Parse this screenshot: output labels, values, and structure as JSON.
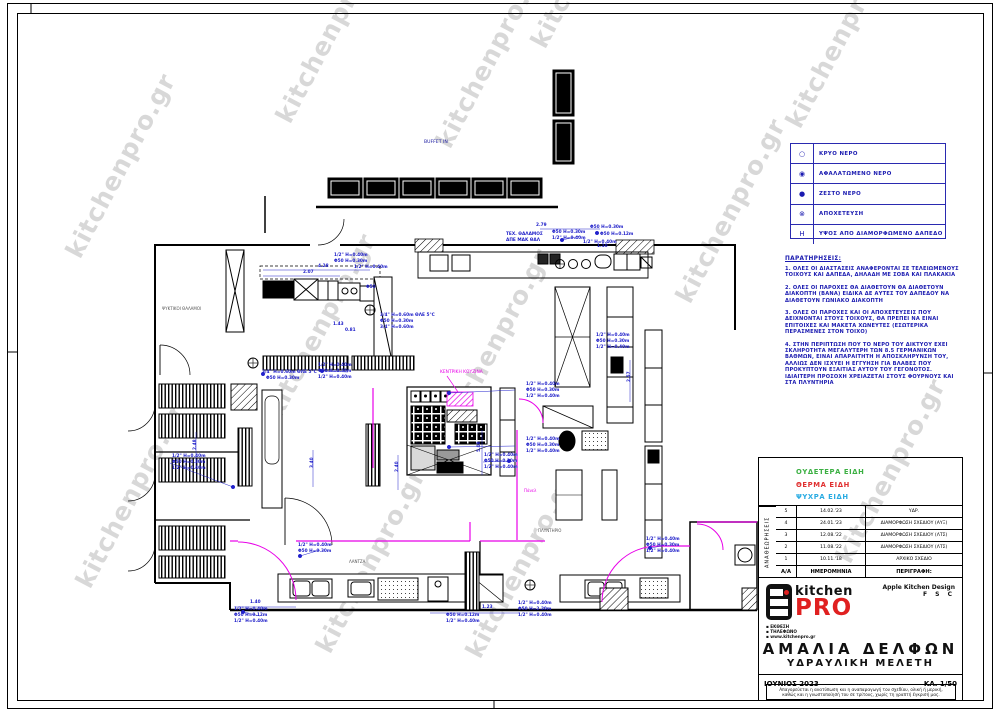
{
  "watermark": {
    "text": "kitchenpro.gr",
    "color": "#b9b9b9",
    "positions": [
      [
        90,
        590
      ],
      [
        80,
        260
      ],
      [
        290,
        125
      ],
      [
        280,
        420
      ],
      [
        330,
        655
      ],
      [
        450,
        150
      ],
      [
        455,
        435
      ],
      [
        480,
        660
      ],
      [
        545,
        50
      ],
      [
        690,
        305
      ],
      [
        800,
        130
      ],
      [
        850,
        565
      ]
    ]
  },
  "legend": {
    "rows": [
      {
        "symbol": "○",
        "label": "ΚΡΥΟ ΝΕΡΟ"
      },
      {
        "symbol": "◉",
        "label": "ΑΦΑΛΑΤΩΜΕΝΟ ΝΕΡΟ"
      },
      {
        "symbol": "●",
        "label": "ΖΕΣΤΟ ΝΕΡΟ"
      },
      {
        "symbol": "⊗",
        "label": "ΑΠΟΧΕΤΕΥΣΗ"
      },
      {
        "symbol": "Η",
        "label": "ΥΨΟΣ ΑΠΟ ΔΙΑΜΟΡΦΩΜΕΝΟ ΔΑΠΕΔΟ"
      }
    ]
  },
  "notes": {
    "title": "ΠΑΡΑΤΗΡΗΣΕΙΣ:",
    "items": [
      "1.  ΟΛΕΣ ΟΙ ΔΙΑΣΤΑΣΕΙΣ ΑΝΑΦΕΡΟΝΤΑΙ ΣΕ ΤΕΛΕΙΩΜΕΝΟΥΣ ΤΟΙΧΟΥΣ ΚΑΙ ΔΑΠΕΔΑ, ΔΗΛΑΔΗ ΜΕ ΣΟΒΑ ΚΑΙ ΠΛΑΚΑΚΙΑ",
      "2.  ΟΛΕΣ ΟΙ ΠΑΡΟΧΕΣ ΘΑ ΔΙΑΘΕΤΟΥΝ ΘΑ ΔΙΑΘΕΤΟΥΝ ΔΙΑΚΟΠΤΗ (ΒΑΝΑ) ΕΙΔΙΚΑ ΔΕ ΑΥΤΕΣ ΤΟΥ ΔΑΠΕΔΟΥ ΝΑ ΔΙΑΘΕΤΟΥΝ ΓΩΝΙΑΚΟ ΔΙΑΚΟΠΤΗ",
      "3.  ΟΛΕΣ ΟΙ ΠΑΡΟΧΕΣ ΚΑΙ ΟΙ ΑΠΟΧΕΤΕΥΣΕΙΣ ΠΟΥ ΔΕΙΧΝΟΝΤΑΙ ΣΤΟΥΣ ΤΟΙΧΟΥΣ, ΘΑ ΠΡΕΠΕΙ ΝΑ ΕΙΝΑΙ ΕΠΙΤΟΙΧΕΣ ΚΑΙ ΜΑΚΕΤΑ ΧΩΝΕΥΤΕΣ (ΕΣΩΤΕΡΙΚΑ ΠΕΡΑΣΜΕΝΕΣ ΣΤΟΝ ΤΟΙΧΟ)",
      "4.  ΣΤΗΝ ΠΕΡΙΠΤΩΣΗ ΠΟΥ ΤΟ ΝΕΡΟ ΤΟΥ ΔΙΚΤΥΟΥ ΕΧΕΙ ΣΚΛΗΡΟΤΗΤΑ ΜΕΓΑΛΥΤΕΡΗ ΤΩΝ 8.5 ΓΕΡΜΑΝΙΚΩΝ ΒΑΘΜΩΝ, ΕΙΝΑΙ ΑΠΑΡΑΙΤΗΤΗ Η ΑΠΟΣΚΛΗΡΥΝΣΗ ΤΟΥ, ΑΛΛΙΩΣ ΔΕΝ ΙΣΧΥΕΙ Η ΕΓΓΥΗΣΗ ΓΙΑ ΒΛΑΒΕΣ ΠΟΥ ΠΡΟΚΥΠΤΟΥΝ ΕΞΑΙΤΙΑΣ ΑΥΤΟΥ ΤΟΥ ΓΕΓΟΝΟΤΟΣ. ΙΔΙΑΙΤΕΡΗ ΠΡΟΣΟΧΗ ΧΡΕΙΑΖΕΤΑΙ ΣΤΟΥΣ ΦΟΥΡΝΟΥΣ ΚΑΙ ΣΤΑ ΠΛΥΝΤΗΡΙΑ"
    ]
  },
  "color_key": [
    {
      "label": "ΟΥΔΕΤΕΡΑ ΕΙΔΗ",
      "color": "#3cb043"
    },
    {
      "label": "ΘΕΡΜΑ ΕΙΔΗ",
      "color": "#e03030"
    },
    {
      "label": "ΨΥΧΡΑ ΕΙΔΗ",
      "color": "#29abe2"
    }
  ],
  "revisions": {
    "vertical_label": "ΑΝΑΘΕΩΡΗΣΕΙΣ",
    "header": {
      "num": "Α/Α",
      "date": "ΗΜΕΡΟΜΗΝΙΑ",
      "desc": "ΠΕΡΙΓΡΑΦΗ:"
    },
    "rows": [
      {
        "num": "5",
        "date": "14.02.'23",
        "desc": "ΥΔΡ."
      },
      {
        "num": "4",
        "date": "24.01.'23",
        "desc": "ΔΙΑΜΟΡΦΩΣΗ ΣΧΕΔΙΟΥ (ΑΥΞ)"
      },
      {
        "num": "3",
        "date": "12.08.'22",
        "desc": "ΔΙΑΜΟΡΦΩΣΗ ΣΧΕΔΙΟΥ (ΛΤΣ)"
      },
      {
        "num": "2",
        "date": "11.08.'22",
        "desc": "ΔΙΑΜΟΡΦΩΣΗ ΣΧΕΔΙΟΥ (ΛΤΣ)"
      },
      {
        "num": "1",
        "date": "10.11.'18",
        "desc": "ΑΡΧΙΚΟ ΣΧΕΔΙΟ"
      }
    ]
  },
  "title_block": {
    "brand_kitchen": "kitchen",
    "brand_pro": "PRO",
    "designer_line1": "Apple Kitchen Design",
    "designer_line2": "F S C",
    "contact": [
      "▪ ΕΚΘΕΣΗ",
      "▪ ΤΗΛΕΦΩΝΟ",
      "▪ www.kitchenpro.gr"
    ],
    "project_title": "ΑΜΑΛΙΑ  ΔΕΛΦΩΝ",
    "project_subtitle": "ΥΔΡΑΥΛΙΚΗ  ΜΕΛΕΤΗ",
    "date": "ΙΟΥΝΙΟΣ 2023",
    "scale": "ΚΛ. 1/50",
    "disclaimer": "Απαγορεύεται η ανατύπωση και η αναπαραγωγή του σχεδίου, ολική ή μερική, καθώς και η γνωστοποίησή του σε τρίτους, χωρίς τη γραπτή έγκρισή μας."
  },
  "plan": {
    "colors": {
      "dim": "#1c1cc8",
      "magenta": "#e800e8",
      "label": "#555555"
    },
    "labels": [
      {
        "t": "BUFFET IN",
        "x": 424,
        "y": 143,
        "c": "#15159e",
        "s": 4.6
      },
      {
        "t": "ΚΕΝΤΡΙΚΗ ΚΟΥΖΙΝΑ",
        "x": 440,
        "y": 373,
        "c": "#e800e8",
        "s": 4.4
      },
      {
        "t": "ΨΥΚΤΙΚΟΙ ΘΑΛΑΜΟΙ",
        "x": 162,
        "y": 310,
        "c": "#555555",
        "s": 4
      },
      {
        "t": "ΛΑΝΤΖΑ",
        "x": 349,
        "y": 563,
        "c": "#555555",
        "s": 4
      },
      {
        "t": "ΠΛΥΝΤΗΡΙΟ",
        "x": 538,
        "y": 532,
        "c": "#555555",
        "s": 4
      },
      {
        "t": "Πάνελ",
        "x": 524,
        "y": 492,
        "c": "#e800e8",
        "s": 4
      }
    ],
    "dims": [
      {
        "t": "2.79",
        "x": 536,
        "y": 226
      },
      {
        "t": "Φ50 Η=0.30m",
        "x": 552,
        "y": 233
      },
      {
        "t": "1/2\" Η=0.40m",
        "x": 552,
        "y": 239
      },
      {
        "t": "Φ50 Η=0.30m",
        "x": 590,
        "y": 228
      },
      {
        "t": "Φ50 Η=0.12m",
        "x": 600,
        "y": 235
      },
      {
        "t": "1/2\" Η=0.40m",
        "x": 583,
        "y": 243
      },
      {
        "t": "ΤΕΧ. ΘΑΛΑΜΟΣ",
        "x": 506,
        "y": 235
      },
      {
        "t": "ΑΠΕ ΜΑΚ ΘΑΛ",
        "x": 506,
        "y": 241
      },
      {
        "t": "1.10",
        "x": 597,
        "y": 247
      },
      {
        "t": "4.28",
        "x": 318,
        "y": 267
      },
      {
        "t": "2.07",
        "x": 303,
        "y": 273
      },
      {
        "t": "1/2\" Η=0.40m",
        "x": 334,
        "y": 256
      },
      {
        "t": "Φ50 Η=0.30m",
        "x": 334,
        "y": 262
      },
      {
        "t": "1/2\" Η=0.40m",
        "x": 354,
        "y": 268
      },
      {
        "t": "Φ50",
        "x": 366,
        "y": 288
      },
      {
        "t": "3/4\" Η=0.60m ΘΛΕ 5°C",
        "x": 380,
        "y": 316
      },
      {
        "t": "Φ50 Η=0.30m",
        "x": 380,
        "y": 322
      },
      {
        "t": "3/4\" Η=0.60m",
        "x": 380,
        "y": 328
      },
      {
        "t": "1.43",
        "x": 333,
        "y": 325
      },
      {
        "t": "0.81",
        "x": 345,
        "y": 331
      },
      {
        "t": "3/4\" Η=0.60m ΘΛΕ 5°C",
        "x": 262,
        "y": 373
      },
      {
        "t": "Φ50 Η=0.30m",
        "x": 266,
        "y": 379
      },
      {
        "t": "1/2\" Η=0.40m",
        "x": 318,
        "y": 366
      },
      {
        "t": "Φ50 Η=0.30m",
        "x": 318,
        "y": 372
      },
      {
        "t": "1/2\" Η=0.40m",
        "x": 318,
        "y": 378
      },
      {
        "t": "1/2\" Η=0.40m",
        "x": 172,
        "y": 457
      },
      {
        "t": "Φ50 Η=0.30m",
        "x": 172,
        "y": 463
      },
      {
        "t": "1/2\" Η=0.40m",
        "x": 172,
        "y": 469
      },
      {
        "t": "1/2\" Η=0.40m",
        "x": 298,
        "y": 546
      },
      {
        "t": "Φ50 Η=0.30m",
        "x": 298,
        "y": 552
      },
      {
        "t": "1/2\" Η=0.40m",
        "x": 526,
        "y": 385
      },
      {
        "t": "Φ50 Η=0.30m",
        "x": 526,
        "y": 391
      },
      {
        "t": "1/2\" Η=0.40m",
        "x": 526,
        "y": 397
      },
      {
        "t": "1/2\" Η=0.40m",
        "x": 526,
        "y": 440
      },
      {
        "t": "Φ50 Η=0.30m",
        "x": 526,
        "y": 446
      },
      {
        "t": "1/2\" Η=0.40m",
        "x": 526,
        "y": 452
      },
      {
        "t": "1/2\" Η=0.40m",
        "x": 484,
        "y": 456
      },
      {
        "t": "Φ50 Η=0.30m",
        "x": 484,
        "y": 462
      },
      {
        "t": "1/2\" Η=0.40m",
        "x": 484,
        "y": 468
      },
      {
        "t": "5.08",
        "x": 480,
        "y": 452,
        "r": -90
      },
      {
        "t": "3.40",
        "x": 313,
        "y": 468,
        "r": -90
      },
      {
        "t": "2.48",
        "x": 196,
        "y": 450,
        "r": -90
      },
      {
        "t": "2.40",
        "x": 398,
        "y": 472,
        "r": -90
      },
      {
        "t": "2.57",
        "x": 630,
        "y": 382,
        "r": -90
      },
      {
        "t": "1/2\" Η=0.40m",
        "x": 596,
        "y": 336
      },
      {
        "t": "Φ50 Η=0.30m",
        "x": 596,
        "y": 342
      },
      {
        "t": "1/2\" Η=0.40m",
        "x": 596,
        "y": 348
      },
      {
        "t": "1.40",
        "x": 250,
        "y": 603
      },
      {
        "t": "1/2\" Η=0.40m",
        "x": 234,
        "y": 610
      },
      {
        "t": "Φ50 Η=0.12m",
        "x": 234,
        "y": 616
      },
      {
        "t": "1/2\" Η=0.40m",
        "x": 234,
        "y": 622
      },
      {
        "t": "1.23",
        "x": 482,
        "y": 608
      },
      {
        "t": "Φ50 Η=0.12m",
        "x": 446,
        "y": 616
      },
      {
        "t": "1/2\" Η=0.40m",
        "x": 446,
        "y": 622
      },
      {
        "t": "1/2\" Η=0.40m",
        "x": 518,
        "y": 604
      },
      {
        "t": "Φ50 Η=2.20m",
        "x": 518,
        "y": 610
      },
      {
        "t": "1/2\" Η=0.40m",
        "x": 518,
        "y": 616
      },
      {
        "t": "1/2\" Η=0.40m",
        "x": 646,
        "y": 540
      },
      {
        "t": "Φ50 Η=0.30m",
        "x": 646,
        "y": 546
      },
      {
        "t": "1/2\" Η=0.40m",
        "x": 646,
        "y": 552
      }
    ]
  }
}
